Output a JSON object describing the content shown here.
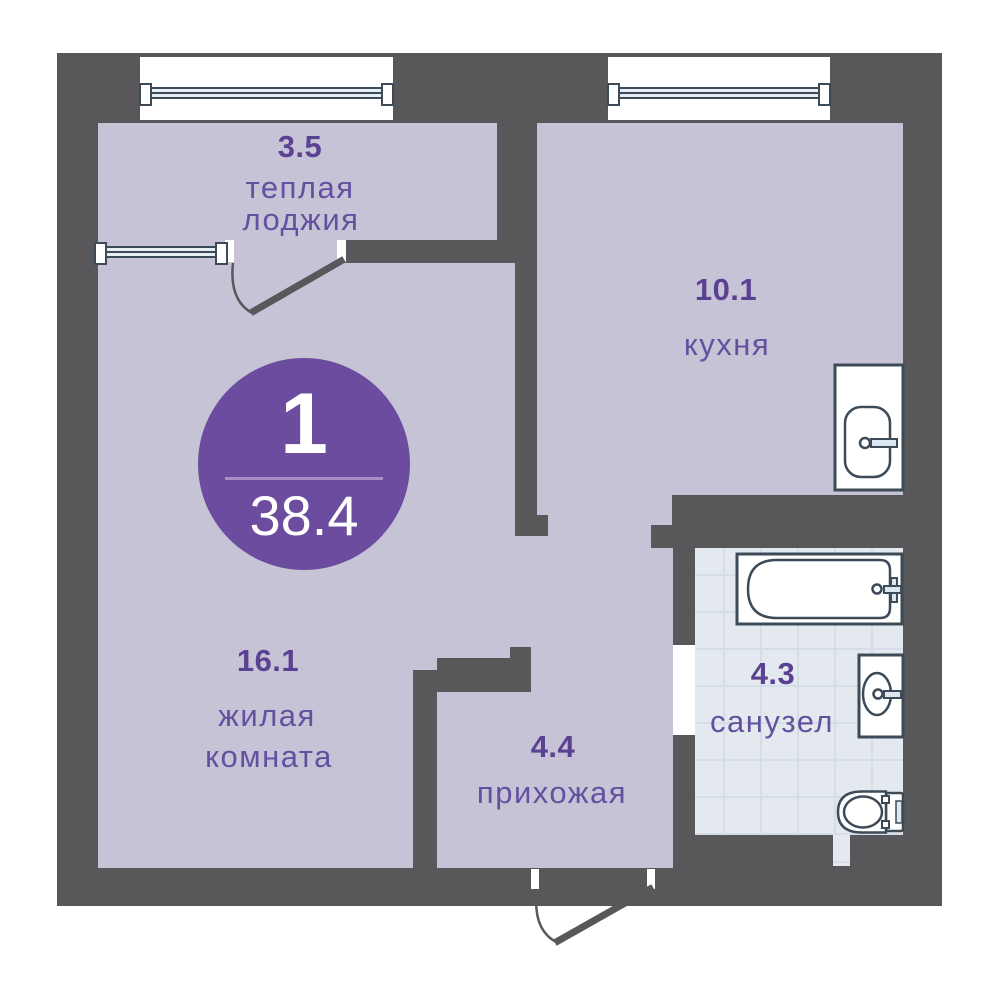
{
  "plan": {
    "badge": {
      "room_count": "1",
      "total_area": "38.4"
    },
    "rooms": [
      {
        "id": "loggia",
        "area": "3.5",
        "lines": [
          "теплая",
          "лоджия"
        ]
      },
      {
        "id": "kitchen",
        "area": "10.1",
        "lines": [
          "кухня"
        ]
      },
      {
        "id": "living",
        "area": "16.1",
        "lines": [
          "жилая",
          "комната"
        ]
      },
      {
        "id": "hallway",
        "area": "4.4",
        "lines": [
          "прихожая"
        ]
      },
      {
        "id": "bathroom",
        "area": "4.3",
        "lines": [
          "санузел"
        ]
      }
    ],
    "colors": {
      "wall": "#58575a",
      "floor": "#c7c3d7",
      "tile": "#e4e9f0",
      "tile_line": "#d5dde9",
      "fixture": "#3d4a57",
      "fixture_fill": "#ffffff",
      "glass": "#e6eef4",
      "accent_fill": "#dce7f0",
      "label_number": "#5a4191",
      "label_name": "#63519f",
      "badge": "#6b4c9f",
      "badge_divider": "#a78fc9",
      "badge_text": "#ffffff"
    }
  }
}
